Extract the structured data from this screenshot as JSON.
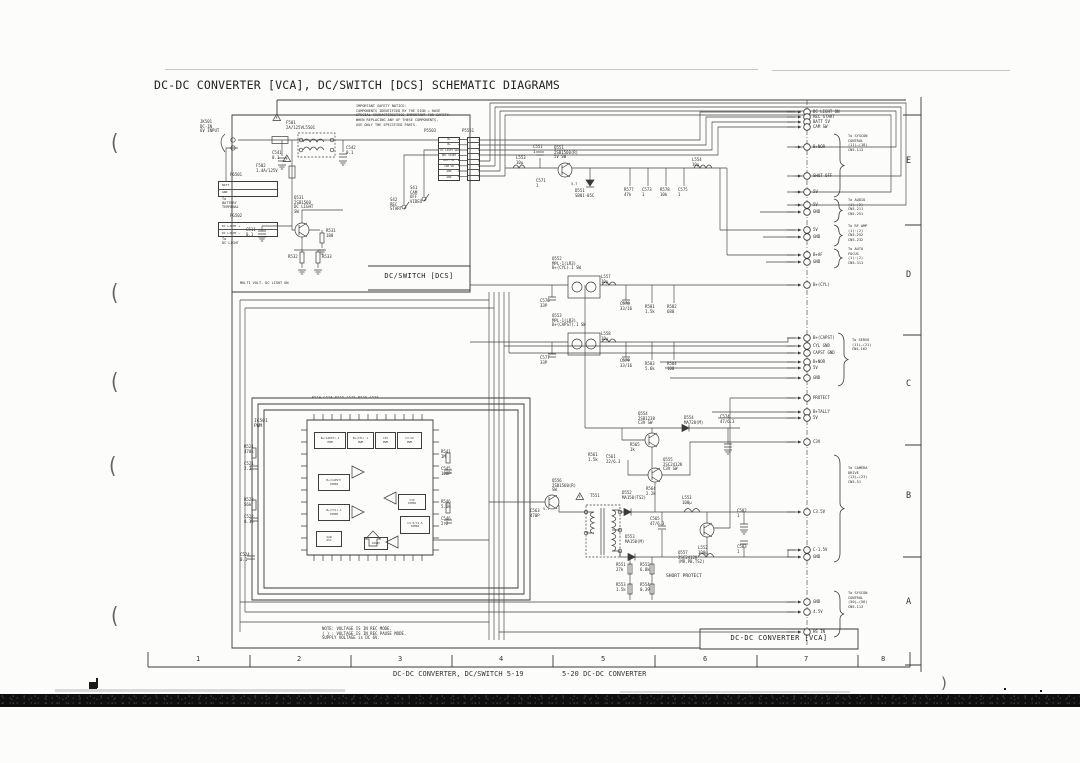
{
  "title": "DC-DC CONVERTER [VCA], DC/SWITCH [DCS] SCHEMATIC DIAGRAMS",
  "footer": {
    "left": "DC-DC CONVERTER, DC/SWITCH  5-19",
    "right": "5-20  DC-DC CONVERTER"
  },
  "grid": {
    "cols": [
      "1",
      "2",
      "3",
      "4",
      "5",
      "6",
      "7",
      "8"
    ],
    "rows": [
      "E",
      "D",
      "C",
      "B",
      "A"
    ]
  },
  "sections": {
    "dcs": "DC/SWITCH [DCS]",
    "vca": "DC-DC CONVERTER [VCA]"
  },
  "notes": {
    "safety": "IMPORTANT SAFETY NOTICE:\nCOMPONENTS IDENTIFIED BY THE SIGN ⚠ HAVE\nSPECIAL CHARACTERISTICS IMPORTANT FOR SAFETY.\nWHEN REPLACING ANY OF THESE COMPONENTS,\nUSE ONLY THE SPECIFIED PARTS.",
    "voltage": "NOTE: VOLTAGE IS IN REC MODE.\n( ) : VOLTAGE IS IN REC PAUSE MODE.\nSUPPLY VOLTAGE is DC 6V.",
    "multi": "MULTI VOLT. DC LIGHT ON"
  },
  "connector": {
    "left_name": "P5503",
    "right_name": "P5551",
    "rows": [
      "B+",
      "B+",
      "DC LIGHT SW",
      "REC START",
      "BATT 5V",
      "CAM SW",
      "GND",
      "GND"
    ]
  },
  "sub_connectors": {
    "p6501": {
      "name": "P6501",
      "rows": [
        "BATT",
        "GND"
      ],
      "dest": "To\nBATTERY\nTERMINAL"
    },
    "pg502": {
      "name": "PG502",
      "rows": [
        "DC LIGHT +",
        "DC LIGHT −"
      ],
      "dest": "To\nDC LIGHT"
    }
  },
  "switches": {
    "s41": "S41\nCAM\nOFF\nVIDEO",
    "s42": "S42\nREC\nSTART"
  },
  "ic": {
    "name": "IC501\nPWM",
    "top_row": "R534  C534  R535  C535  R536  C536",
    "blocks": [
      "B+(CAPST).1\nPWM",
      "B+(CYL).1\nPWM",
      "C3V\nPWM",
      "C3.5V\nPWM",
      "B+(CAPST)\nCOMPA",
      "B+(CYL).1\nCOMPA",
      "C3V\nCOMPA",
      "C3.5/C1.5\nCOMPA",
      "SAW\nOSC",
      "LOGIC"
    ]
  },
  "parts": [
    "JK501\nDC-IN\n6V INPUT",
    "F501\n2A/125V",
    "L5501",
    "C541\n0.1",
    "C542\n0.1",
    "F502\n1.4A/125V",
    "Q531\n2SB1560\nDC LIGHT\nSW",
    "R531\n180",
    "C511\n0.1",
    "R532",
    "R533",
    "C551\n1",
    "L553\n10μ",
    "Q551\n2SB1560(R)\n5V SW",
    "C571\n1",
    "D551\nSB01-05C",
    "R577\n47k",
    "C573\n1",
    "R578\n10k",
    "C575\n1",
    "L554\n10μ",
    "Q552\nMPL-1(LR3)\nB+(CYL).1 SW",
    "Q553\nMPL-1(LR3)\nB+(CAPST).1 SW",
    "C576\n33P",
    "C577\n33P",
    "L557\n10μ",
    "L558\n10μ",
    "C578\n33/16",
    "C579\n33/16",
    "R581\n1.5k",
    "R582\n680",
    "R583\n5.6k",
    "R584\n100",
    "R521\n470k",
    "C521\n2.2",
    "R522\n56k",
    "C522\n0.15",
    "C524\n0.1",
    "R541\n1M",
    "C545\n100P",
    "R546\n5.6k",
    "C546\n2.2",
    "Q554\n2SB1238\nC3V SW",
    "D554\nMA728(M)",
    "C574\n47/6.3",
    "R565\n1k",
    "R561\n1.5k",
    "C561\n22/6.3",
    "Q555\n2SC2412K\nC3V SW",
    "R564\n2.2k",
    "Q556\n2SB1560(R)\nSW",
    "T551",
    "D552\nMA150(TS2)",
    "D553\nMA150(M)",
    "L551\n100μ",
    "C565\n47/6.3",
    "L552\n100μ",
    "C582\n1",
    "C583\n1",
    "Q557\n2SC2412K\n(MR,PB,TS2)",
    "SHORT PROTECT",
    "R551\n27k",
    "R552\n6.8k",
    "R553\n1.5k",
    "R554\n0.39",
    "C563\n470P"
  ],
  "pins": [
    "DC LIGHT ON",
    "REC START",
    "BATT 5V",
    "CAM SW",
    "B+NOR",
    "SHUT OFF",
    "5V",
    "5V",
    "GND",
    "5V",
    "GND",
    "B+AF",
    "GND",
    "B+(CYL)",
    "B+(CAPST)",
    "CYL GND",
    "CAPST GND",
    "B+NOR",
    "5V",
    "GND",
    "PROTECT",
    "B+TALLY",
    "5V",
    "C3V",
    "C3.5V",
    "C-1.5V",
    "GND",
    "GND",
    "4.5V",
    "HS IN"
  ],
  "dests": [
    "To SYSCON\nCONTROL\n(11)—(18)\nCN5-113",
    "To AUDIO\n(1)·(2)\nCN5-211\nCN5-251",
    "To RF AMP\n(1)·(2)\nCN5-252\nCN5-232",
    "To AUTO\nFOCUS\n(1)·(2)\nCN5-311",
    "To SERVO\n(11)—(21)\nCN5-162",
    "To CAMERA\nDRIVE\n(13)—(23)\nCN5-51",
    "To SYSCON\nCONTROL\n(50)—(56)\nCN5-113"
  ],
  "volts": [
    "5.7",
    "5.7"
  ],
  "artifacts": {
    "paren": "(",
    "close_paren": ")"
  }
}
